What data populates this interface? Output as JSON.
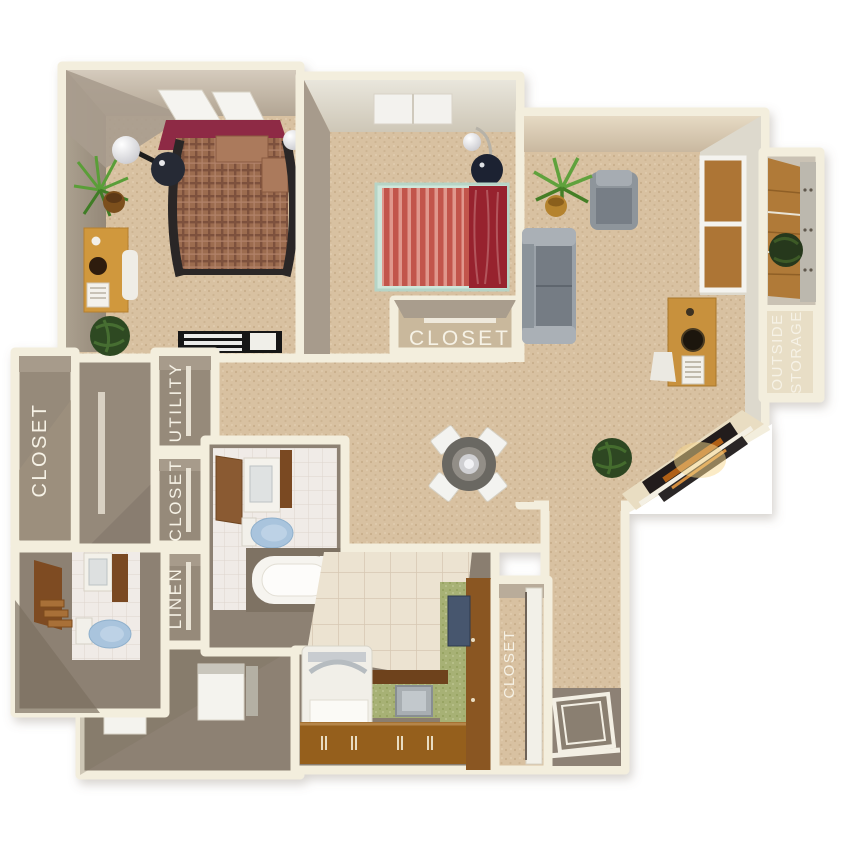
{
  "labels": {
    "closet_left": "CLOSET",
    "utility": "UTILITY",
    "closet_hall": "CLOSET",
    "linen": "LINEN",
    "closet_bedroom2": "CLOSET",
    "outside_storage_line1": "OUTSIDE",
    "outside_storage_line2": "STORAGE",
    "closet_entry": "CLOSET"
  },
  "palette": {
    "outline_cream": "#f3eedd",
    "carpet_tan": "#d8c1a1",
    "floor_taupe": "#8d8173",
    "wall_face": "#a79b8b",
    "bathroom_tile": "#f0ebe7",
    "kitchen_tile": "#ece3d1",
    "counter_green": "#a7b175",
    "cabinet_brown": "#8a5a22",
    "bed1_headboard_maroon": "#8e2944",
    "bed1_plaid_brown": "#9c6c50",
    "bed2_stripe_red": "#c2554c",
    "bed2_blanket_red": "#97242e",
    "sofa_gray": "#9aa1a8",
    "toilet_blue": "#a9c4dd",
    "label_white": "#f6f2e6",
    "plant_green": "#5a9e38",
    "desk_wood": "#d0983e",
    "fireplace_glow": "#f8d88e",
    "storage_wood": "#b07a38"
  }
}
